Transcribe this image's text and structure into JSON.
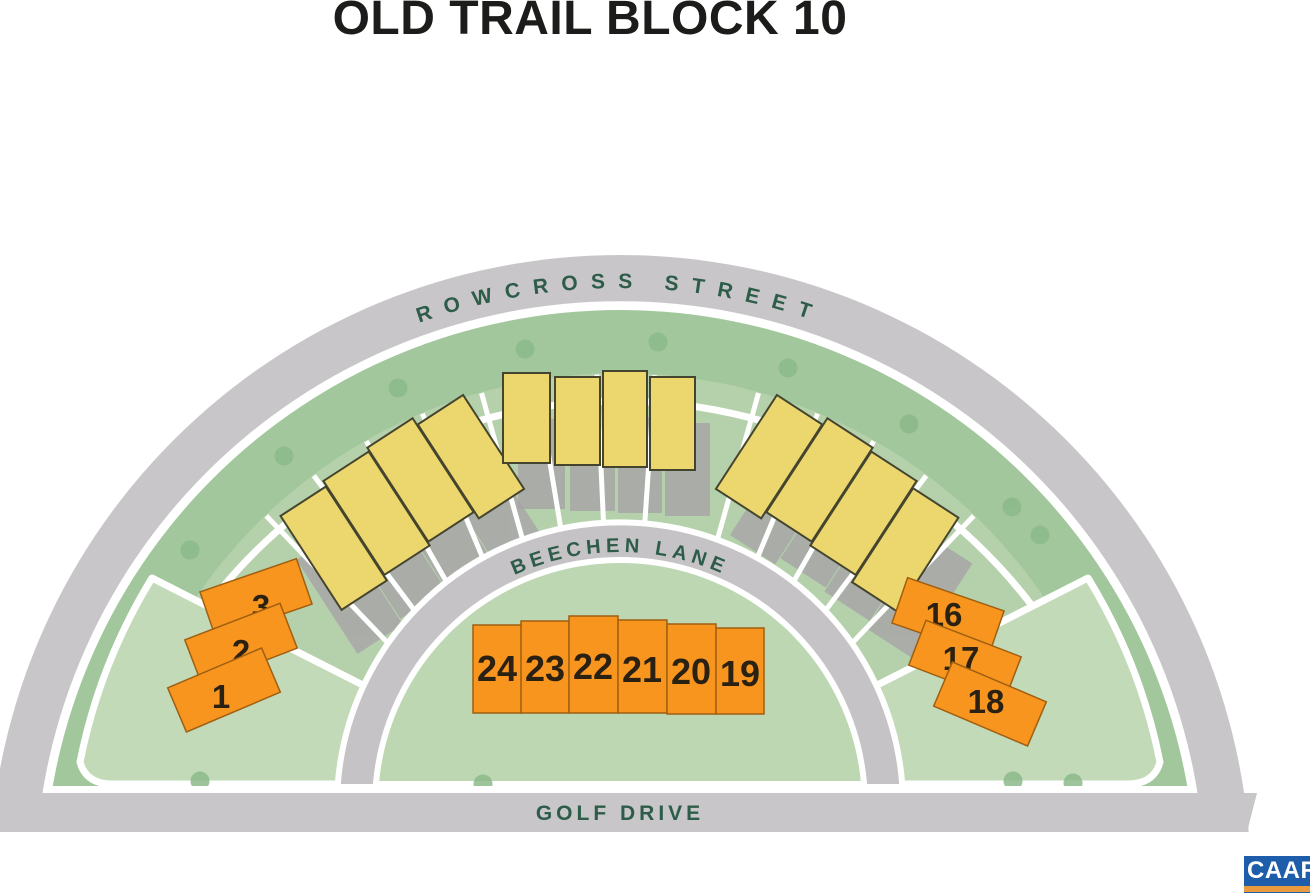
{
  "title": "OLD TRAIL BLOCK 10",
  "streets": {
    "rowcross": "ROWCROSS STREET",
    "beechen": "BEECHEN LANE",
    "golf": "GOLF DRIVE"
  },
  "lots": {
    "left": [
      "3",
      "2",
      "1"
    ],
    "center": [
      "24",
      "23",
      "22",
      "21",
      "20",
      "19"
    ],
    "right": [
      "16",
      "17",
      "18"
    ]
  },
  "buildings": {
    "left_group_units": 4,
    "center_group_units": 4,
    "right_group_units": 4
  },
  "logo": {
    "name": "CAAR"
  },
  "colors": {
    "lot_fill": "#f7951f",
    "lot_outline": "#a05f10",
    "building_fill": "#ecd76f",
    "building_outline": "#45452f",
    "road_gray": "#c9c6c9",
    "beechen_gray": "#c6c3c6",
    "tree_ring_green": "#a3c79d",
    "interior_green": "#b5d1ab",
    "wedge_green": "#c2dab8",
    "inner_court_green": "#bcd7b2",
    "tree_dot_green": "#8cba8a",
    "street_text_green": "#2d5c49",
    "logo_blue": "#1d5da9",
    "logo_orange": "#eb9a3d"
  }
}
